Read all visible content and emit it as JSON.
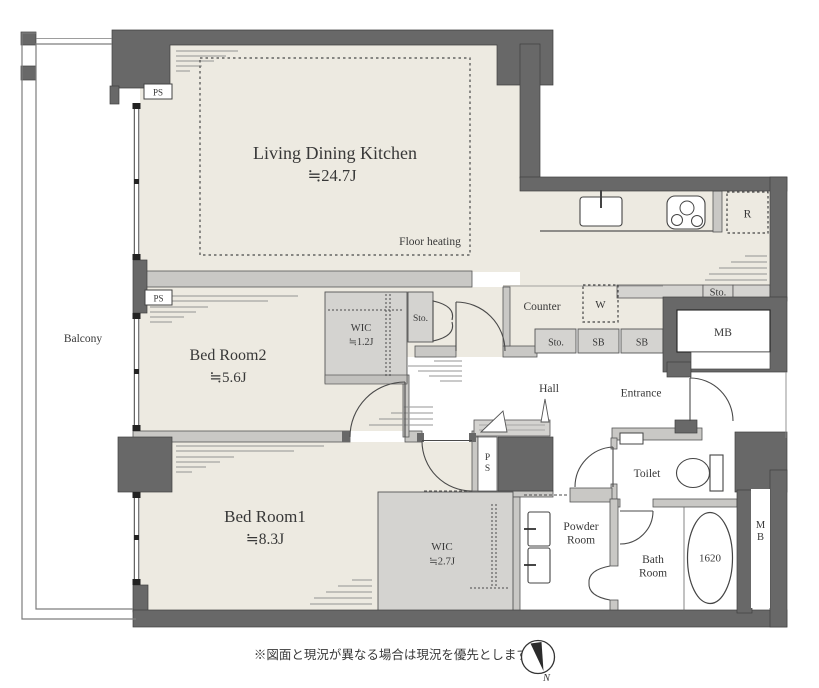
{
  "plan": {
    "rooms": {
      "ldk": {
        "name": "Living Dining Kitchen",
        "size": "≒24.7J"
      },
      "bedroom2": {
        "name": "Bed Room2",
        "size": "≒5.6J"
      },
      "bedroom1": {
        "name": "Bed Room1",
        "size": "≒8.3J"
      },
      "wic_small": {
        "name": "WIC",
        "size": "≒1.2J"
      },
      "wic_large": {
        "name": "WIC",
        "size": "≒2.7J"
      },
      "balcony": "Balcony",
      "hall": "Hall",
      "entrance": "Entrance",
      "toilet": "Toilet",
      "powder_room": {
        "line1": "Powder",
        "line2": "Room"
      },
      "bath_room": {
        "line1": "Bath",
        "line2": "Room"
      },
      "counter": "Counter"
    },
    "labels": {
      "floor_heating": "Floor heating",
      "tub_size": "1620",
      "refrigerator": "R",
      "washer": "W",
      "storage": "Sto.",
      "shoe_box": "SB",
      "meter_box": "MB",
      "pipe_space": "PS"
    },
    "note": "※図面と現況が異なる場合は現況を優先とします。",
    "compass": {
      "north": "N"
    },
    "colors": {
      "wall": "#686868",
      "floor": "#edeae1",
      "fixture_gray": "#d4d3d0",
      "partition_gray": "#c9c8c5",
      "line": "#3f3f3f"
    }
  }
}
